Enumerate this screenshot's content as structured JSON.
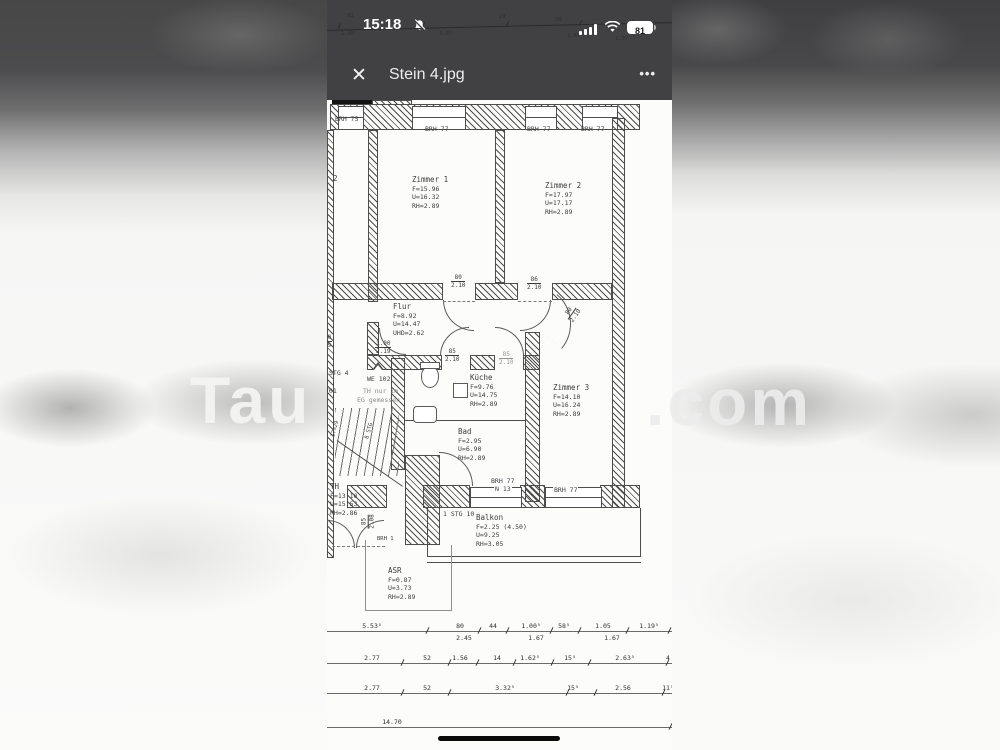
{
  "status_bar": {
    "time": "15:18",
    "battery_percent": "81",
    "ghost_dims_above": [
      "91",
      "29",
      "96"
    ],
    "ghost_dims_below": [
      "1.48",
      "1.87",
      "1.67",
      "1.57"
    ]
  },
  "header": {
    "close_glyph": "✕",
    "title": "Stein 4.jpg",
    "more_glyph": "•••"
  },
  "watermark": {
    "left": "Tau",
    "right": ".com"
  },
  "colors": {
    "topbar": "#414143",
    "plan_ink": "#4d4d4d",
    "battery_pill": "#ffffff"
  },
  "floorplan": {
    "rooms": [
      {
        "name": "Zimmer 1",
        "f": "F=15.96",
        "u": "U=16.32",
        "h": "RH=2.89"
      },
      {
        "name": "Zimmer 2",
        "f": "F=17.97",
        "u": "U=17.17",
        "h": "RH=2.89"
      },
      {
        "name": "Flur",
        "f": "F=8.92",
        "u": "U=14.47",
        "h": "UHD=2.62"
      },
      {
        "name": "Küche",
        "f": "F=9.76",
        "u": "U=14.75",
        "h": "RH=2.89"
      },
      {
        "name": "Bad",
        "f": "F=2.95",
        "u": "U=6.90",
        "h": "RH=2.89"
      },
      {
        "name": "Zimmer 3",
        "f": "F=14.10",
        "u": "U=16.24",
        "h": "RH=2.89"
      },
      {
        "name": "TH",
        "f": "F=13.10",
        "u": "U=15.53",
        "h": "RH=2.86"
      },
      {
        "name": "Balkon",
        "f": "F=2.25 (4.50)",
        "u": "U=9.25",
        "h": "RH=3.05"
      },
      {
        "name": "ASR",
        "f": "F=0.87",
        "u": "U=3.73",
        "h": "RH=2.89"
      }
    ],
    "window_labels": [
      "BRH 75",
      "BRH 77",
      "BRH 77",
      "BRH 77",
      "BRH 77",
      "N 13",
      "BRH 77",
      "BRH 1"
    ],
    "door_labels": [
      {
        "top": "80",
        "bottom": "2.10"
      },
      {
        "top": "86",
        "bottom": "2.10"
      },
      {
        "top": "85",
        "bottom": "2.10"
      },
      {
        "top": "85",
        "bottom": "2.10"
      },
      {
        "top": "1.00",
        "bottom": "2.19"
      },
      {
        "top": "80",
        "bottom": "2.10"
      },
      {
        "top": "85",
        "bottom": "2.08"
      },
      {
        "top": "00",
        "bottom": "19"
      }
    ],
    "misc_labels": [
      "2",
      "STG 4",
      "701",
      "WE 102",
      "TH nur im",
      "EG gemessen",
      "1 STG 10",
      "8 STG",
      "17=29"
    ],
    "dimensions": {
      "row1_top": [
        "5.53⁵",
        "80",
        "44",
        "1.00⁵",
        "58⁵",
        "1.05",
        "1.19⁵"
      ],
      "row1_bottom": [
        "2.45",
        "1.67",
        "1.67"
      ],
      "row2": [
        "2.77",
        "52",
        "1.56",
        "14",
        "1.62⁵",
        "15⁵",
        "2.63⁵",
        "4"
      ],
      "row3": [
        "2.77",
        "52",
        "3.32⁵",
        "15⁵",
        "2.56",
        "11⁵"
      ],
      "row4": [
        "14.70"
      ]
    }
  }
}
